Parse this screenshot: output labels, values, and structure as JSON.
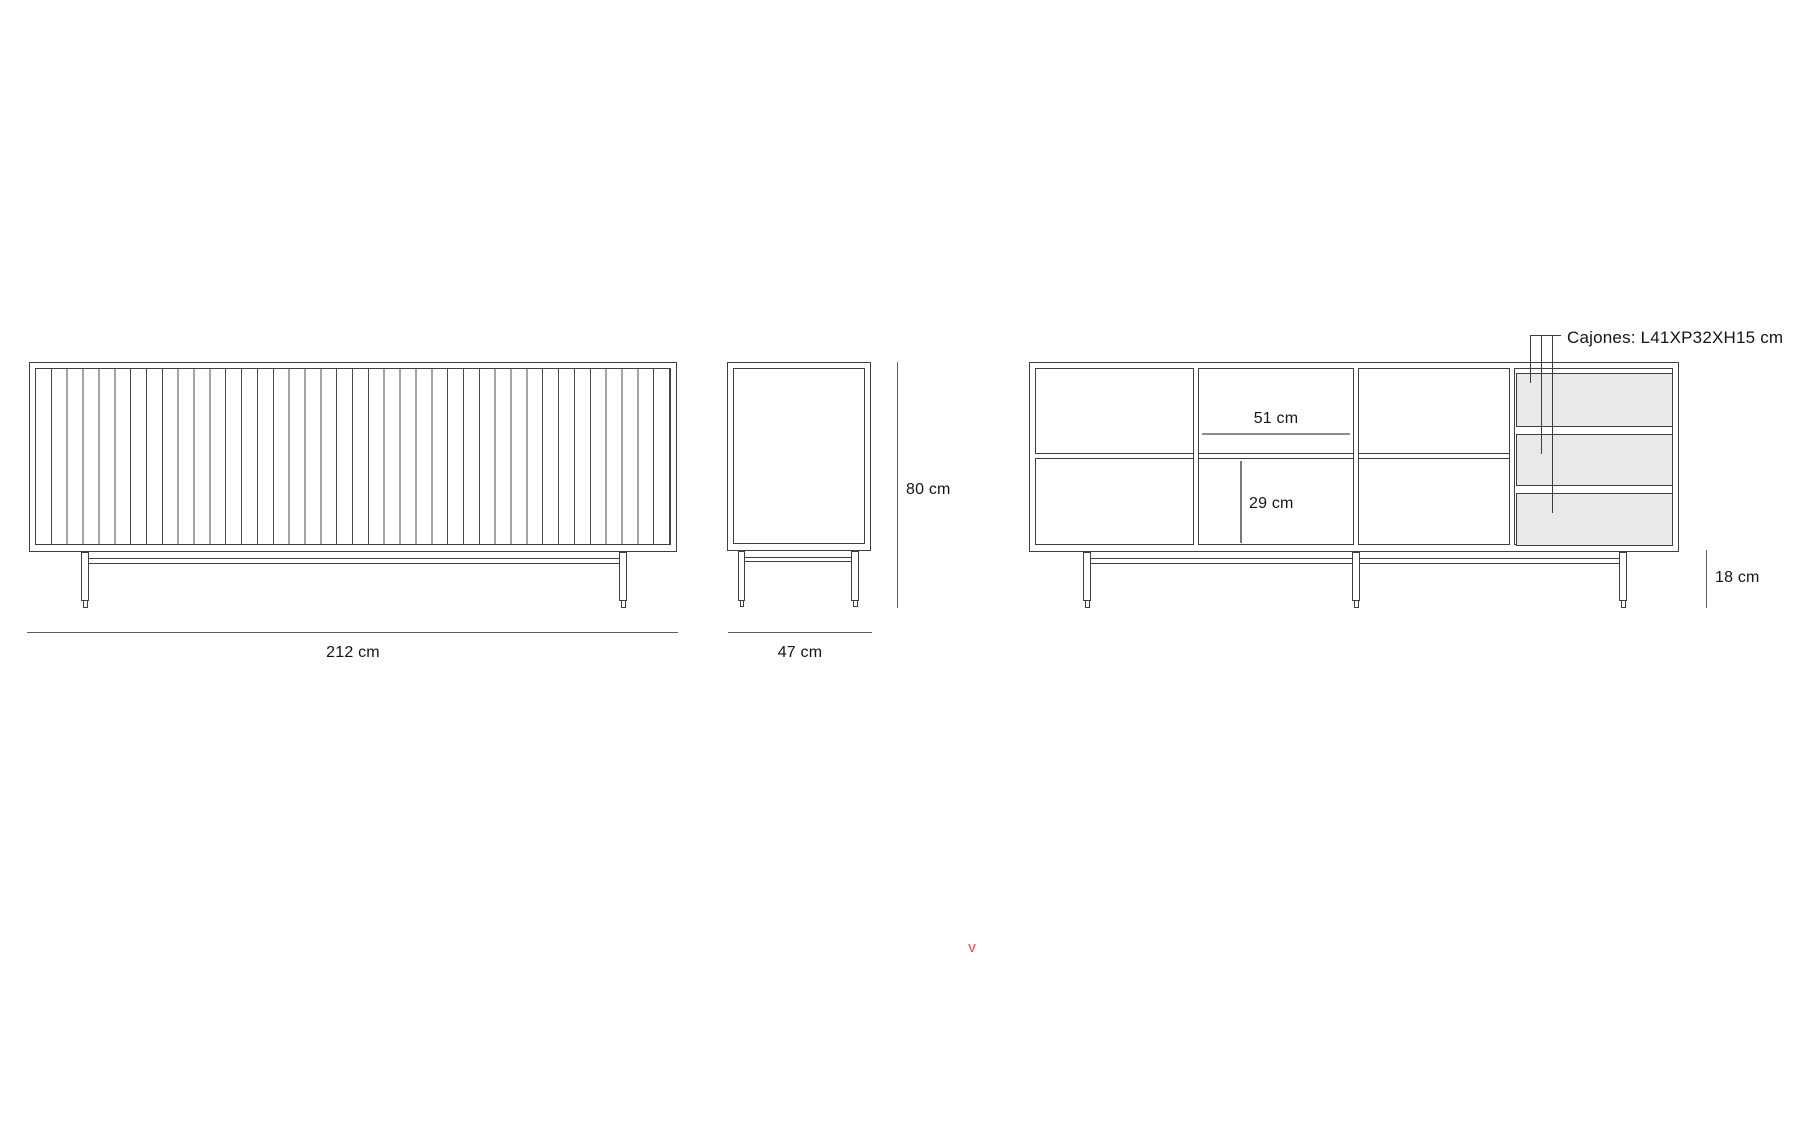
{
  "colors": {
    "background": "#ffffff",
    "outline": "#3f3f3f",
    "dimension_line": "#5f5f5f",
    "shelf_dimension_line": "#8a8a8a",
    "text": "#141414",
    "drawer_fill": "#e9e9e9",
    "accent_red": "#ff4136"
  },
  "front_view": {
    "width_label": "212 cm"
  },
  "side_view": {
    "depth_label": "47 cm",
    "height_label": "80 cm"
  },
  "internal_view": {
    "shelf_width_label": "51 cm",
    "compartment_height_label": "29 cm",
    "legs_height_label": "18 cm",
    "drawers_spec_label": "Cajones: L41XP32XH15 cm"
  },
  "marker": {
    "glyph": "v"
  }
}
